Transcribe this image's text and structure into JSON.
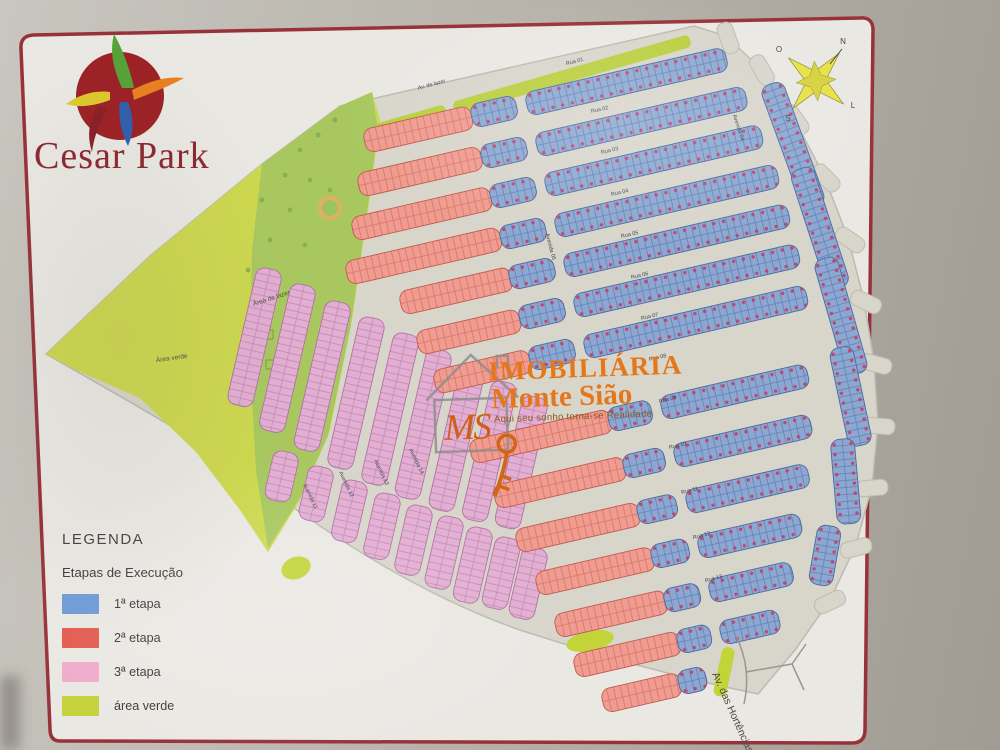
{
  "poster": {
    "brand": "Cesar Park",
    "frame_color": "#993139",
    "paper_color": "#eae8e3"
  },
  "legend": {
    "title": "LEGENDA",
    "subtitle": "Etapas de Execução",
    "items": [
      {
        "label": "1ª etapa",
        "color": "#6d9ad5"
      },
      {
        "label": "2ª etapa",
        "color": "#e25a4e"
      },
      {
        "label": "3ª etapa",
        "color": "#efabcb"
      },
      {
        "label": "área verde",
        "color": "#c5d23b"
      }
    ]
  },
  "watermark": {
    "monogram": "MS",
    "line1": "IMOBILIÁRIA",
    "line2": "Monte Sião",
    "tagline": "Aqui seu sonho torna-se Realidade",
    "orange": "#e4771b",
    "monogram_color": "#cf5f16",
    "tagline_color": "#8a5a1d"
  },
  "compass": {
    "n": "N",
    "s": "S",
    "e": "L",
    "w": "O",
    "star_color": "#e8e146"
  },
  "map": {
    "palette": {
      "street": "#d8d5cb",
      "street_edge": "#bdbab1",
      "e1_fill": "#8ca8d2",
      "e1_line": "#6280b2",
      "e1_stroke": "#4b6a9e",
      "e2_fill": "#f09c90",
      "e2_line": "#d4756a",
      "e2_stroke": "#c25a4e",
      "e3_fill": "#e2aed2",
      "e3_line": "#c389b2",
      "e3_stroke": "#b172a2",
      "dot": "#c83a60",
      "green_big": "#cdd84f",
      "green_dark": "#a4c761",
      "green_strip": "#b9cf3f",
      "green_blob": "#c3d439",
      "label_color": "#3e4650"
    },
    "silhouette": "M46,354 L150,256 262,164 340,106 694,26 726,36 760,68 794,118 824,176 848,238 864,300 874,362 878,424 872,486 856,545 830,600 795,650 758,694 C680,678 600,656 520,630 C440,602 360,556 280,498 C220,452 120,396 46,354 Z",
    "green_big_pts": "46,354 150,256 262,164 340,106 372,92 380,120 368,210 352,320 330,430 300,500 268,552 240,510 196,452 140,398 80,372",
    "green_dark_pts": "262,164 340,106 372,92 378,130 366,220 350,330 328,436 300,498 268,548 256,470 250,360 252,250",
    "green_strips": [
      [
        375,
        124,
        72,
        -16
      ],
      [
        452,
        102,
        246,
        -16
      ]
    ],
    "green_blobs": [
      [
        296,
        568,
        15,
        11,
        -20
      ],
      [
        590,
        641,
        24,
        10,
        -12
      ]
    ],
    "green_median": [
      723,
      646,
      13,
      50,
      12
    ],
    "park_ring": {
      "cx": 330,
      "cy": 208,
      "r": 10,
      "ring": "#e0b060",
      "fill": "#9cc45e"
    },
    "speckles": [
      [
        262,
        200
      ],
      [
        285,
        175
      ],
      [
        300,
        150
      ],
      [
        318,
        135
      ],
      [
        335,
        120
      ],
      [
        310,
        180
      ],
      [
        290,
        210
      ],
      [
        270,
        240
      ],
      [
        305,
        245
      ],
      [
        330,
        190
      ],
      [
        248,
        270
      ]
    ],
    "sketch_marks": [
      [
        256,
        300
      ],
      [
        260,
        330
      ],
      [
        266,
        360
      ]
    ],
    "stubs": [
      [
        728,
        38,
        70
      ],
      [
        762,
        70,
        60
      ],
      [
        796,
        120,
        55
      ],
      [
        826,
        178,
        45
      ],
      [
        850,
        240,
        35
      ],
      [
        866,
        302,
        25
      ],
      [
        876,
        364,
        15
      ],
      [
        879,
        426,
        5
      ],
      [
        872,
        488,
        -5
      ],
      [
        856,
        548,
        -15
      ],
      [
        830,
        602,
        -25
      ]
    ],
    "blocks": [
      [
        283,
        272,
        140,
        103,
        3
      ],
      [
        317,
        288,
        150,
        103,
        3
      ],
      [
        352,
        305,
        152,
        103,
        3
      ],
      [
        386,
        321,
        154,
        103,
        3
      ],
      [
        420,
        337,
        154,
        103,
        3
      ],
      [
        453,
        353,
        152,
        103,
        3
      ],
      [
        486,
        369,
        148,
        103,
        3
      ],
      [
        518,
        385,
        142,
        103,
        3
      ],
      [
        549,
        400,
        134,
        103,
        3
      ],
      [
        300,
        455,
        50,
        103,
        3
      ],
      [
        335,
        470,
        55,
        103,
        3
      ],
      [
        369,
        484,
        62,
        103,
        3
      ],
      [
        402,
        497,
        66,
        103,
        3
      ],
      [
        434,
        509,
        70,
        103,
        3
      ],
      [
        465,
        520,
        73,
        103,
        3
      ],
      [
        494,
        531,
        76,
        103,
        3
      ],
      [
        522,
        541,
        72,
        103,
        3
      ],
      [
        549,
        551,
        72,
        103,
        3
      ],
      [
        362,
        130,
        110,
        -13,
        2
      ],
      [
        356,
        174,
        126,
        -13,
        2
      ],
      [
        350,
        218,
        142,
        -13,
        2
      ],
      [
        344,
        262,
        158,
        -13,
        2
      ],
      [
        398,
        292,
        114,
        -13,
        2
      ],
      [
        415,
        332,
        105,
        -13,
        2
      ],
      [
        432,
        371,
        98,
        -13,
        2
      ],
      [
        468,
        441,
        144,
        -13,
        2
      ],
      [
        492,
        486,
        134,
        -13,
        2
      ],
      [
        514,
        530,
        126,
        -13,
        2
      ],
      [
        534,
        573,
        120,
        -13,
        2
      ],
      [
        553,
        615,
        114,
        -13,
        2
      ],
      [
        572,
        655,
        108,
        -13,
        2
      ],
      [
        600,
        690,
        80,
        -13,
        2
      ],
      [
        469,
        105,
        46,
        -13,
        1
      ],
      [
        479,
        146,
        46,
        -13,
        1
      ],
      [
        488,
        186,
        46,
        -13,
        1
      ],
      [
        498,
        227,
        46,
        -13,
        1
      ],
      [
        507,
        267,
        46,
        -13,
        1
      ],
      [
        517,
        307,
        46,
        -13,
        1
      ],
      [
        527,
        348,
        46,
        -13,
        1
      ],
      [
        606,
        409,
        44,
        -13,
        1
      ],
      [
        621,
        456,
        42,
        -13,
        1
      ],
      [
        635,
        502,
        40,
        -13,
        1
      ],
      [
        649,
        546,
        38,
        -13,
        1
      ],
      [
        662,
        590,
        36,
        -13,
        1
      ],
      [
        675,
        631,
        34,
        -13,
        1
      ],
      [
        676,
        672,
        28,
        -13,
        1
      ],
      [
        524,
        93,
        205,
        -13,
        1
      ],
      [
        534,
        134,
        215,
        -13,
        1
      ],
      [
        543,
        174,
        222,
        -13,
        1
      ],
      [
        553,
        215,
        228,
        -13,
        1
      ],
      [
        562,
        255,
        230,
        -13,
        1
      ],
      [
        572,
        295,
        230,
        -13,
        1
      ],
      [
        582,
        336,
        228,
        -13,
        1
      ],
      [
        659,
        397,
        150,
        -13,
        1
      ],
      [
        672,
        445,
        140,
        -13,
        1
      ],
      [
        684,
        491,
        125,
        -13,
        1
      ],
      [
        696,
        536,
        105,
        -13,
        1
      ],
      [
        707,
        580,
        85,
        -13,
        1
      ],
      [
        718,
        622,
        60,
        -13,
        1
      ],
      [
        782,
        80,
        130,
        70,
        1
      ],
      [
        812,
        165,
        125,
        72,
        1
      ],
      [
        836,
        255,
        120,
        74,
        1
      ],
      [
        852,
        345,
        100,
        78,
        1
      ],
      [
        854,
        438,
        85,
        85,
        1
      ],
      [
        842,
        528,
        60,
        100,
        1
      ]
    ],
    "street_labels": [
      [
        "Rua 01",
        575,
        63,
        -15
      ],
      [
        "Rua 02",
        600,
        111,
        -13
      ],
      [
        "Rua 03",
        610,
        152,
        -13
      ],
      [
        "Rua 04",
        620,
        194,
        -13
      ],
      [
        "Rua 05",
        630,
        236,
        -13
      ],
      [
        "Rua 06",
        640,
        277,
        -13
      ],
      [
        "Rua 07",
        650,
        318,
        -13
      ],
      [
        "Rua 08",
        658,
        359,
        -13
      ],
      [
        "Rua 09",
        668,
        401,
        -13
      ],
      [
        "Rua 10",
        678,
        447,
        -13
      ],
      [
        "Rua 11",
        690,
        492,
        -14
      ],
      [
        "Rua 12",
        702,
        537,
        -15
      ],
      [
        "Rua 13",
        714,
        580,
        -16
      ],
      [
        "Avenida 05",
        549,
        247,
        75
      ],
      [
        "Avenida 04",
        737,
        128,
        72
      ],
      [
        "Avenida 11",
        309,
        497,
        64
      ],
      [
        "Avenida 12",
        345,
        485,
        64
      ],
      [
        "Avenida 13",
        380,
        473,
        64
      ],
      [
        "Avenida 14",
        415,
        462,
        64
      ],
      [
        "Av. de lazer",
        432,
        86,
        -15
      ]
    ],
    "area_labels": [
      [
        "Área de lazer",
        272,
        300,
        -18
      ],
      [
        "Área verde",
        172,
        360,
        -8
      ]
    ],
    "avenue_bottom": {
      "text": "Av. das Hortências",
      "x": 712,
      "y": 674,
      "rot": 66,
      "color": "#4e4d45"
    }
  }
}
